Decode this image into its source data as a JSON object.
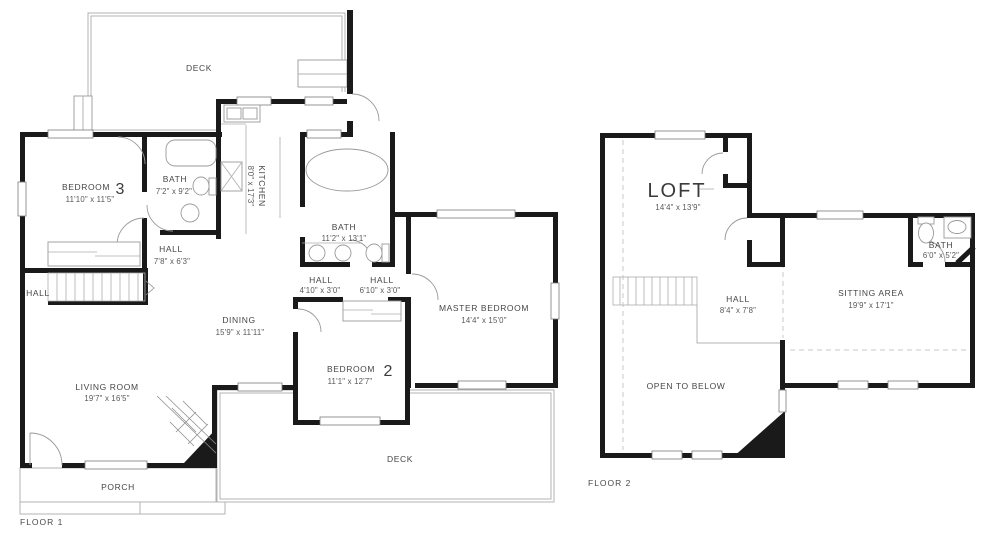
{
  "floor1": {
    "label": "FLOOR 1",
    "rooms": {
      "deck_top": {
        "name": "DECK"
      },
      "bedroom3": {
        "name": "BEDROOM",
        "number": "3",
        "dims": "11'10\" x 11'5\""
      },
      "bath1": {
        "name": "BATH",
        "dims": "7'2\" x 9'2\""
      },
      "kitchen": {
        "name": "KITCHEN",
        "dims": "8'0\" x 17'3\""
      },
      "bath2": {
        "name": "BATH",
        "dims": "11'2\" x 13'1\""
      },
      "hall1": {
        "name": "HALL",
        "dims": "7'8\" x 6'3\""
      },
      "hall_left": {
        "name": "HALL"
      },
      "hall2": {
        "name": "HALL",
        "dims": "4'10\" x 3'0\""
      },
      "hall3": {
        "name": "HALL",
        "dims": "6'10\" x 3'0\""
      },
      "master_bedroom": {
        "name": "MASTER BEDROOM",
        "dims": "14'4\" x 15'0\""
      },
      "dining": {
        "name": "DINING",
        "dims": "15'9\" x 11'11\""
      },
      "bedroom2": {
        "name": "BEDROOM",
        "number": "2",
        "dims": "11'1\" x 12'7\""
      },
      "living_room": {
        "name": "LIVING ROOM",
        "dims": "19'7\" x 16'5\""
      },
      "deck_bottom": {
        "name": "DECK"
      },
      "porch": {
        "name": "PORCH"
      }
    }
  },
  "floor2": {
    "label": "FLOOR 2",
    "rooms": {
      "loft": {
        "name": "LOFT",
        "dims": "14'4\" x 13'9\""
      },
      "bath": {
        "name": "BATH",
        "dims": "6'0\" x 5'2\""
      },
      "hall": {
        "name": "HALL",
        "dims": "8'4\" x 7'8\""
      },
      "sitting_area": {
        "name": "SITTING AREA",
        "dims": "19'9\" x 17'1\""
      },
      "open_to_below": {
        "name": "OPEN TO BELOW"
      }
    }
  },
  "colors": {
    "wall": "#1a1a1a",
    "outline": "#b3b3b3",
    "text": "#474747"
  }
}
